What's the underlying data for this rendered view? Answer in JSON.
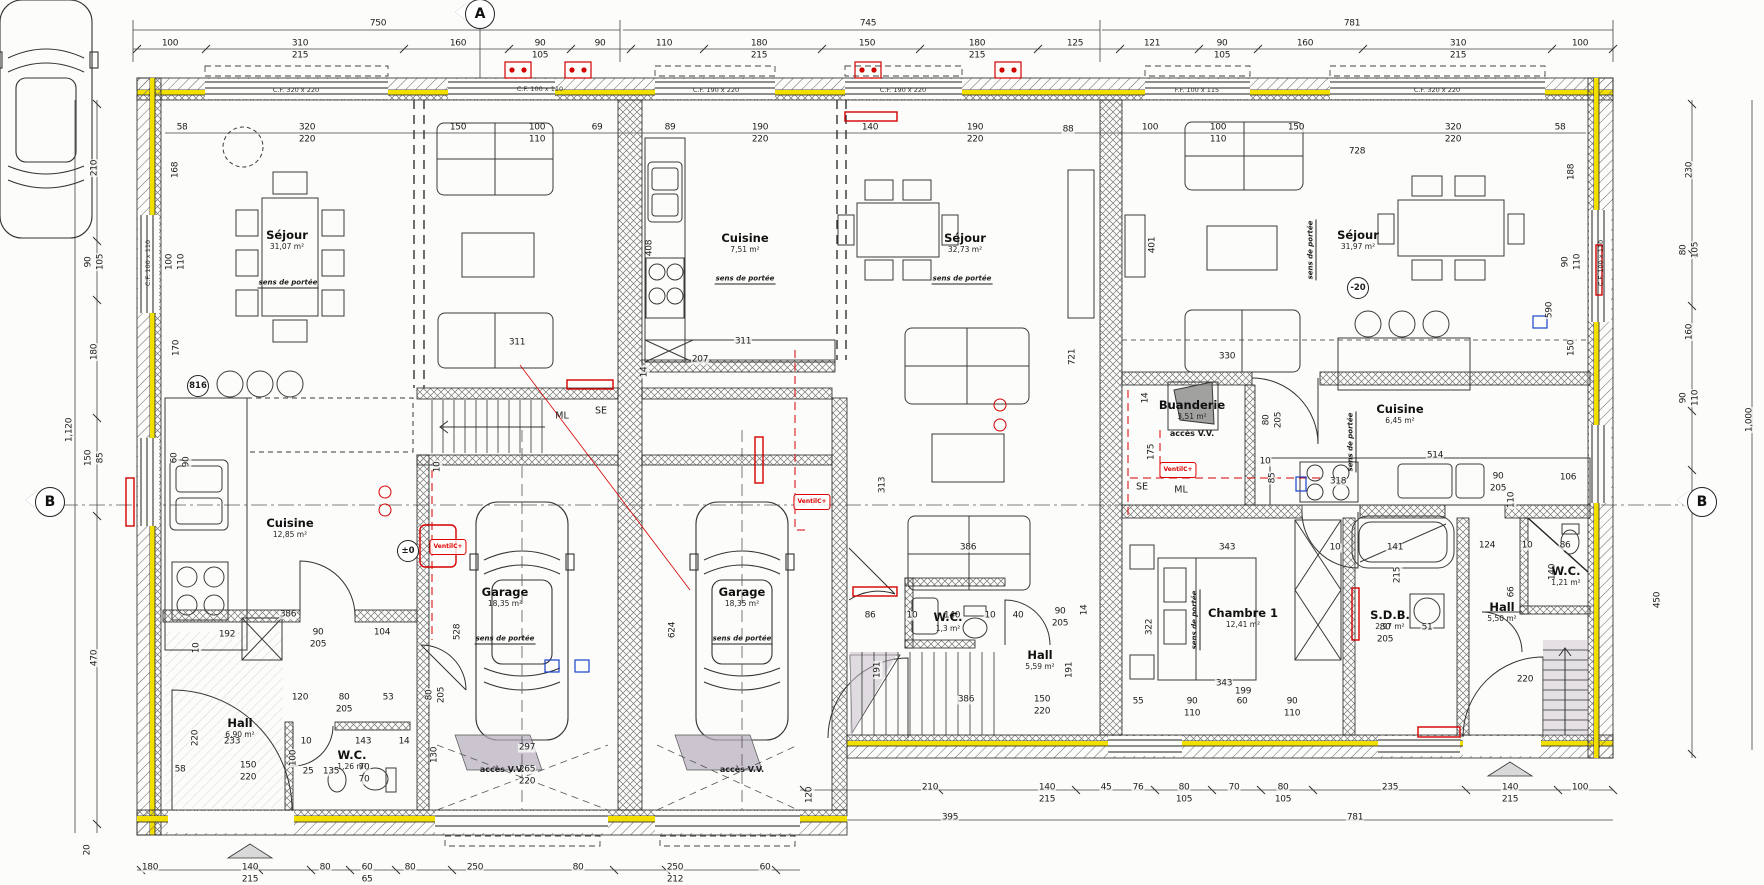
{
  "plan": {
    "type": "floor-plan",
    "units": 3,
    "language": "fr"
  },
  "markers": [
    {
      "t": "A",
      "x": 480,
      "y": 14,
      "name": "section-marker-a"
    },
    {
      "t": "B",
      "x": 50,
      "y": 502,
      "name": "section-marker-b-left"
    },
    {
      "t": "B",
      "x": 1702,
      "y": 502,
      "name": "section-marker-b-right"
    }
  ],
  "rooms": [
    {
      "name": "sejour-1",
      "label": "Séjour",
      "area": "31,07 m²",
      "x": 287,
      "y": 240
    },
    {
      "name": "cuisine-1",
      "label": "Cuisine",
      "area": "12,85 m²",
      "x": 290,
      "y": 528
    },
    {
      "name": "hall-1",
      "label": "Hall",
      "area": "6,90 m²",
      "x": 240,
      "y": 728
    },
    {
      "name": "wc-1",
      "label": "W.C.",
      "area": "1,26 m²",
      "x": 352,
      "y": 760
    },
    {
      "name": "garage-1",
      "label": "Garage",
      "area": "18,35 m²",
      "x": 505,
      "y": 597
    },
    {
      "name": "garage-2",
      "label": "Garage",
      "area": "18,35 m²",
      "x": 742,
      "y": 597
    },
    {
      "name": "cuisine-2",
      "label": "Cuisine",
      "area": "7,51 m²",
      "x": 745,
      "y": 243
    },
    {
      "name": "sejour-2",
      "label": "Séjour",
      "area": "32,73 m²",
      "x": 965,
      "y": 243
    },
    {
      "name": "wc-2",
      "label": "W.C.",
      "area": "1,3 m²",
      "x": 948,
      "y": 622
    },
    {
      "name": "hall-2",
      "label": "Hall",
      "area": "5,59 m²",
      "x": 1040,
      "y": 660
    },
    {
      "name": "sejour-3",
      "label": "Séjour",
      "area": "31,97 m²",
      "x": 1358,
      "y": 240
    },
    {
      "name": "buanderie",
      "label": "Buanderie",
      "area": "3,51 m²",
      "x": 1192,
      "y": 410
    },
    {
      "name": "cuisine-3",
      "label": "Cuisine",
      "area": "6,45 m²",
      "x": 1400,
      "y": 414
    },
    {
      "name": "chambre-1",
      "label": "Chambre 1",
      "area": "12,41 m²",
      "x": 1243,
      "y": 618
    },
    {
      "name": "sdb",
      "label": "S.D.B.",
      "area": "2,97 m²",
      "x": 1390,
      "y": 620
    },
    {
      "name": "hall-3",
      "label": "Hall",
      "area": "5,50 m²",
      "x": 1502,
      "y": 612
    },
    {
      "name": "wc-3",
      "label": "W.C.",
      "area": "1,21 m²",
      "x": 1566,
      "y": 576
    }
  ],
  "window_labels": [
    {
      "t": "C.F. 320 x 220",
      "x": 296,
      "y": 90
    },
    {
      "t": "C.F. 100 x 110",
      "x": 540,
      "y": 89
    },
    {
      "t": "C.F. 190 x 220",
      "x": 716,
      "y": 90
    },
    {
      "t": "C.F. 190 x 220",
      "x": 903,
      "y": 90
    },
    {
      "t": "F.F. 100 x 115",
      "x": 1197,
      "y": 90
    },
    {
      "t": "C.F. 320 x 220",
      "x": 1437,
      "y": 90
    },
    {
      "t": "C.F. 100 x 110",
      "x": 148,
      "y": 263,
      "r": 1
    },
    {
      "t": "C.F. 100 x 110",
      "x": 1601,
      "y": 263,
      "r": 1
    }
  ],
  "annotations": [
    {
      "t": "sens de portée",
      "x": 288,
      "y": 284,
      "cls": "sens"
    },
    {
      "t": "sens de portée",
      "x": 505,
      "y": 640,
      "cls": "sens"
    },
    {
      "t": "sens de portée",
      "x": 742,
      "y": 640,
      "cls": "sens"
    },
    {
      "t": "sens de portée",
      "x": 745,
      "y": 280,
      "cls": "sens"
    },
    {
      "t": "sens de portée",
      "x": 962,
      "y": 280,
      "cls": "sens"
    },
    {
      "t": "sens de portée",
      "x": 1312,
      "y": 250,
      "r": 1,
      "cls": "sens"
    },
    {
      "t": "sens de portée",
      "x": 1352,
      "y": 442,
      "r": 1,
      "cls": "sens"
    },
    {
      "t": "sens de portée",
      "x": 1196,
      "y": 620,
      "r": 1,
      "cls": "sens"
    },
    {
      "t": "ML",
      "x": 562,
      "y": 416,
      "cls": "mlse"
    },
    {
      "t": "SE",
      "x": 601,
      "y": 411,
      "cls": "mlse"
    },
    {
      "t": "SE",
      "x": 1142,
      "y": 487,
      "cls": "mlse"
    },
    {
      "t": "ML",
      "x": 1181,
      "y": 490,
      "cls": "mlse"
    },
    {
      "t": "VentilC+",
      "x": 448,
      "y": 547,
      "cls": "vent"
    },
    {
      "t": "VentilC+",
      "x": 812,
      "y": 502,
      "cls": "vent"
    },
    {
      "t": "VentilC+",
      "x": 1178,
      "y": 470,
      "cls": "vent"
    },
    {
      "t": "accès V.V.",
      "x": 502,
      "y": 770,
      "cls": "acces"
    },
    {
      "t": "accès V.V.",
      "x": 742,
      "y": 770,
      "cls": "acces"
    },
    {
      "t": "accès V.V.",
      "x": 1192,
      "y": 434,
      "cls": "acces"
    },
    {
      "t": "-20",
      "x": 1358,
      "y": 288,
      "cls": "circ"
    },
    {
      "t": "±0",
      "x": 408,
      "y": 551,
      "cls": "circ"
    },
    {
      "t": "816",
      "x": 198,
      "y": 386,
      "cls": "circ"
    }
  ],
  "dims": [
    {
      "t": "750",
      "x": 378,
      "y": 24
    },
    {
      "t": "745",
      "x": 868,
      "y": 24
    },
    {
      "t": "781",
      "x": 1352,
      "y": 24
    },
    {
      "t": "100",
      "x": 170,
      "y": 44
    },
    {
      "t": "310",
      "x": 300,
      "y": 44
    },
    {
      "t": "215",
      "x": 300,
      "y": 56
    },
    {
      "t": "160",
      "x": 458,
      "y": 44
    },
    {
      "t": "90",
      "x": 540,
      "y": 44
    },
    {
      "t": "105",
      "x": 540,
      "y": 56
    },
    {
      "t": "90",
      "x": 600,
      "y": 44
    },
    {
      "t": "110",
      "x": 664,
      "y": 44
    },
    {
      "t": "180",
      "x": 759,
      "y": 44
    },
    {
      "t": "215",
      "x": 759,
      "y": 56
    },
    {
      "t": "150",
      "x": 867,
      "y": 44
    },
    {
      "t": "180",
      "x": 977,
      "y": 44
    },
    {
      "t": "215",
      "x": 977,
      "y": 56
    },
    {
      "t": "125",
      "x": 1075,
      "y": 44
    },
    {
      "t": "121",
      "x": 1152,
      "y": 44
    },
    {
      "t": "90",
      "x": 1222,
      "y": 44
    },
    {
      "t": "105",
      "x": 1222,
      "y": 56
    },
    {
      "t": "160",
      "x": 1305,
      "y": 44
    },
    {
      "t": "310",
      "x": 1458,
      "y": 44
    },
    {
      "t": "215",
      "x": 1458,
      "y": 56
    },
    {
      "t": "100",
      "x": 1580,
      "y": 44
    },
    {
      "t": "58",
      "x": 182,
      "y": 128
    },
    {
      "t": "320",
      "x": 307,
      "y": 128
    },
    {
      "t": "220",
      "x": 307,
      "y": 140
    },
    {
      "t": "150",
      "x": 458,
      "y": 128
    },
    {
      "t": "100",
      "x": 537,
      "y": 128
    },
    {
      "t": "110",
      "x": 537,
      "y": 140
    },
    {
      "t": "69",
      "x": 597,
      "y": 128
    },
    {
      "t": "89",
      "x": 670,
      "y": 128
    },
    {
      "t": "190",
      "x": 760,
      "y": 128
    },
    {
      "t": "220",
      "x": 760,
      "y": 140
    },
    {
      "t": "140",
      "x": 870,
      "y": 128
    },
    {
      "t": "190",
      "x": 975,
      "y": 128
    },
    {
      "t": "220",
      "x": 975,
      "y": 140
    },
    {
      "t": "88",
      "x": 1068,
      "y": 130
    },
    {
      "t": "100",
      "x": 1150,
      "y": 128
    },
    {
      "t": "100",
      "x": 1218,
      "y": 128
    },
    {
      "t": "110",
      "x": 1218,
      "y": 140
    },
    {
      "t": "150",
      "x": 1296,
      "y": 128
    },
    {
      "t": "728",
      "x": 1357,
      "y": 152
    },
    {
      "t": "320",
      "x": 1453,
      "y": 128
    },
    {
      "t": "220",
      "x": 1453,
      "y": 140
    },
    {
      "t": "58",
      "x": 1560,
      "y": 128
    },
    {
      "t": "1,120",
      "x": 70,
      "y": 430,
      "r": 1
    },
    {
      "t": "210",
      "x": 95,
      "y": 168,
      "r": 1
    },
    {
      "t": "90",
      "x": 89,
      "y": 262,
      "r": 1
    },
    {
      "t": "105",
      "x": 101,
      "y": 262,
      "r": 1
    },
    {
      "t": "180",
      "x": 95,
      "y": 352,
      "r": 1
    },
    {
      "t": "150",
      "x": 89,
      "y": 458,
      "r": 1
    },
    {
      "t": "85",
      "x": 101,
      "y": 458,
      "r": 1
    },
    {
      "t": "470",
      "x": 95,
      "y": 658,
      "r": 1
    },
    {
      "t": "20",
      "x": 88,
      "y": 850,
      "r": 1
    },
    {
      "t": "168",
      "x": 176,
      "y": 170,
      "r": 1
    },
    {
      "t": "100",
      "x": 170,
      "y": 262,
      "r": 1
    },
    {
      "t": "110",
      "x": 182,
      "y": 262,
      "r": 1
    },
    {
      "t": "170",
      "x": 177,
      "y": 348,
      "r": 1
    },
    {
      "t": "60",
      "x": 175,
      "y": 458,
      "r": 1
    },
    {
      "t": "90",
      "x": 187,
      "y": 462,
      "r": 1
    },
    {
      "t": "220",
      "x": 196,
      "y": 738,
      "r": 1
    },
    {
      "t": "188",
      "x": 1572,
      "y": 172,
      "r": 1
    },
    {
      "t": "90",
      "x": 1566,
      "y": 262,
      "r": 1
    },
    {
      "t": "110",
      "x": 1578,
      "y": 262,
      "r": 1
    },
    {
      "t": "590",
      "x": 1550,
      "y": 310,
      "r": 1
    },
    {
      "t": "150",
      "x": 1572,
      "y": 348,
      "r": 1
    },
    {
      "t": "230",
      "x": 1690,
      "y": 170,
      "r": 1
    },
    {
      "t": "80",
      "x": 1684,
      "y": 250,
      "r": 1
    },
    {
      "t": "105",
      "x": 1696,
      "y": 250,
      "r": 1
    },
    {
      "t": "160",
      "x": 1690,
      "y": 332,
      "r": 1
    },
    {
      "t": "90",
      "x": 1684,
      "y": 398,
      "r": 1
    },
    {
      "t": "110",
      "x": 1696,
      "y": 398,
      "r": 1
    },
    {
      "t": "1,000",
      "x": 1750,
      "y": 420,
      "r": 1
    },
    {
      "t": "450",
      "x": 1658,
      "y": 600,
      "r": 1
    },
    {
      "t": "311",
      "x": 517,
      "y": 343
    },
    {
      "t": "386",
      "x": 288,
      "y": 615
    },
    {
      "t": "192",
      "x": 227,
      "y": 635
    },
    {
      "t": "10",
      "x": 197,
      "y": 648,
      "r": 1
    },
    {
      "t": "90",
      "x": 318,
      "y": 633
    },
    {
      "t": "205",
      "x": 318,
      "y": 645
    },
    {
      "t": "104",
      "x": 382,
      "y": 633
    },
    {
      "t": "120",
      "x": 300,
      "y": 698
    },
    {
      "t": "80",
      "x": 344,
      "y": 698
    },
    {
      "t": "205",
      "x": 344,
      "y": 710
    },
    {
      "t": "53",
      "x": 388,
      "y": 698
    },
    {
      "t": "233",
      "x": 232,
      "y": 742
    },
    {
      "t": "150",
      "x": 248,
      "y": 766
    },
    {
      "t": "220",
      "x": 248,
      "y": 778
    },
    {
      "t": "10",
      "x": 306,
      "y": 742
    },
    {
      "t": "100",
      "x": 294,
      "y": 758,
      "r": 1
    },
    {
      "t": "25",
      "x": 308,
      "y": 772
    },
    {
      "t": "135",
      "x": 331,
      "y": 772
    },
    {
      "t": "70",
      "x": 364,
      "y": 768
    },
    {
      "t": "70",
      "x": 364,
      "y": 780
    },
    {
      "t": "143",
      "x": 363,
      "y": 742
    },
    {
      "t": "14",
      "x": 404,
      "y": 742
    },
    {
      "t": "130",
      "x": 435,
      "y": 755,
      "r": 1
    },
    {
      "t": "58",
      "x": 180,
      "y": 770
    },
    {
      "t": "297",
      "x": 527,
      "y": 748
    },
    {
      "t": "265",
      "x": 527,
      "y": 770
    },
    {
      "t": "220",
      "x": 527,
      "y": 782
    },
    {
      "t": "80",
      "x": 430,
      "y": 695,
      "r": 1
    },
    {
      "t": "205",
      "x": 442,
      "y": 695,
      "r": 1
    },
    {
      "t": "10",
      "x": 438,
      "y": 467,
      "r": 1
    },
    {
      "t": "528",
      "x": 458,
      "y": 632,
      "r": 1
    },
    {
      "t": "624",
      "x": 673,
      "y": 630,
      "r": 1
    },
    {
      "t": "408",
      "x": 650,
      "y": 248,
      "r": 1
    },
    {
      "t": "311",
      "x": 743,
      "y": 342
    },
    {
      "t": "207",
      "x": 700,
      "y": 360
    },
    {
      "t": "14",
      "x": 645,
      "y": 372,
      "r": 1
    },
    {
      "t": "313",
      "x": 883,
      "y": 485,
      "r": 1
    },
    {
      "t": "386",
      "x": 968,
      "y": 548
    },
    {
      "t": "386",
      "x": 966,
      "y": 700
    },
    {
      "t": "86",
      "x": 870,
      "y": 616
    },
    {
      "t": "10",
      "x": 912,
      "y": 616
    },
    {
      "t": "140",
      "x": 952,
      "y": 616
    },
    {
      "t": "10",
      "x": 990,
      "y": 616
    },
    {
      "t": "40",
      "x": 1018,
      "y": 616
    },
    {
      "t": "90",
      "x": 1060,
      "y": 612
    },
    {
      "t": "205",
      "x": 1060,
      "y": 624
    },
    {
      "t": "14",
      "x": 1085,
      "y": 610,
      "r": 1
    },
    {
      "t": "191",
      "x": 878,
      "y": 670,
      "r": 1
    },
    {
      "t": "191",
      "x": 1070,
      "y": 670,
      "r": 1
    },
    {
      "t": "150",
      "x": 1042,
      "y": 700
    },
    {
      "t": "220",
      "x": 1042,
      "y": 712
    },
    {
      "t": "721",
      "x": 1073,
      "y": 357,
      "r": 1
    },
    {
      "t": "401",
      "x": 1153,
      "y": 245,
      "r": 1
    },
    {
      "t": "330",
      "x": 1227,
      "y": 357
    },
    {
      "t": "343",
      "x": 1227,
      "y": 548
    },
    {
      "t": "322",
      "x": 1150,
      "y": 627,
      "r": 1
    },
    {
      "t": "14",
      "x": 1146,
      "y": 398,
      "r": 1
    },
    {
      "t": "175",
      "x": 1152,
      "y": 452,
      "r": 1
    },
    {
      "t": "80",
      "x": 1267,
      "y": 420,
      "r": 1
    },
    {
      "t": "205",
      "x": 1279,
      "y": 420,
      "r": 1
    },
    {
      "t": "10",
      "x": 1265,
      "y": 462
    },
    {
      "t": "85",
      "x": 1273,
      "y": 478,
      "r": 1
    },
    {
      "t": "514",
      "x": 1435,
      "y": 456
    },
    {
      "t": "318",
      "x": 1338,
      "y": 482
    },
    {
      "t": "10",
      "x": 1335,
      "y": 548
    },
    {
      "t": "141",
      "x": 1395,
      "y": 548
    },
    {
      "t": "215",
      "x": 1398,
      "y": 575,
      "r": 1
    },
    {
      "t": "51",
      "x": 1427,
      "y": 628
    },
    {
      "t": "80",
      "x": 1385,
      "y": 628
    },
    {
      "t": "205",
      "x": 1385,
      "y": 640
    },
    {
      "t": "106",
      "x": 1568,
      "y": 478
    },
    {
      "t": "110",
      "x": 1512,
      "y": 500,
      "r": 1
    },
    {
      "t": "124",
      "x": 1487,
      "y": 546
    },
    {
      "t": "10",
      "x": 1527,
      "y": 546
    },
    {
      "t": "86",
      "x": 1565,
      "y": 546
    },
    {
      "t": "66",
      "x": 1512,
      "y": 592,
      "r": 1
    },
    {
      "t": "140",
      "x": 1553,
      "y": 572,
      "r": 1
    },
    {
      "t": "90",
      "x": 1498,
      "y": 477
    },
    {
      "t": "205",
      "x": 1498,
      "y": 489
    },
    {
      "t": "220",
      "x": 1525,
      "y": 680
    },
    {
      "t": "343",
      "x": 1224,
      "y": 684
    },
    {
      "t": "199",
      "x": 1243,
      "y": 692
    },
    {
      "t": "55",
      "x": 1138,
      "y": 702
    },
    {
      "t": "90",
      "x": 1192,
      "y": 702
    },
    {
      "t": "110",
      "x": 1192,
      "y": 714
    },
    {
      "t": "60",
      "x": 1242,
      "y": 702
    },
    {
      "t": "90",
      "x": 1292,
      "y": 702
    },
    {
      "t": "110",
      "x": 1292,
      "y": 714
    },
    {
      "t": "210",
      "x": 930,
      "y": 788
    },
    {
      "t": "140",
      "x": 1047,
      "y": 788
    },
    {
      "t": "215",
      "x": 1047,
      "y": 800
    },
    {
      "t": "45",
      "x": 1106,
      "y": 788
    },
    {
      "t": "76",
      "x": 1138,
      "y": 788
    },
    {
      "t": "80",
      "x": 1184,
      "y": 788
    },
    {
      "t": "105",
      "x": 1184,
      "y": 800
    },
    {
      "t": "70",
      "x": 1234,
      "y": 788
    },
    {
      "t": "80",
      "x": 1283,
      "y": 788
    },
    {
      "t": "105",
      "x": 1283,
      "y": 800
    },
    {
      "t": "235",
      "x": 1390,
      "y": 788
    },
    {
      "t": "140",
      "x": 1510,
      "y": 788
    },
    {
      "t": "215",
      "x": 1510,
      "y": 800
    },
    {
      "t": "100",
      "x": 1580,
      "y": 788
    },
    {
      "t": "395",
      "x": 950,
      "y": 818
    },
    {
      "t": "781",
      "x": 1355,
      "y": 818
    },
    {
      "t": "120",
      "x": 810,
      "y": 795,
      "r": 1
    },
    {
      "t": "180",
      "x": 150,
      "y": 868
    },
    {
      "t": "140",
      "x": 250,
      "y": 868
    },
    {
      "t": "215",
      "x": 250,
      "y": 880
    },
    {
      "t": "80",
      "x": 325,
      "y": 868
    },
    {
      "t": "60",
      "x": 367,
      "y": 868
    },
    {
      "t": "65",
      "x": 367,
      "y": 880
    },
    {
      "t": "80",
      "x": 410,
      "y": 868
    },
    {
      "t": "250",
      "x": 475,
      "y": 868
    },
    {
      "t": "80",
      "x": 578,
      "y": 868
    },
    {
      "t": "250",
      "x": 675,
      "y": 868
    },
    {
      "t": "212",
      "x": 675,
      "y": 880
    },
    {
      "t": "60",
      "x": 765,
      "y": 868
    }
  ],
  "colors": {
    "insulation_yellow": "#f2df00",
    "annotation_red": "#d40000",
    "wall_hatch": "#555",
    "shade_gray": "#b9b2bd"
  }
}
